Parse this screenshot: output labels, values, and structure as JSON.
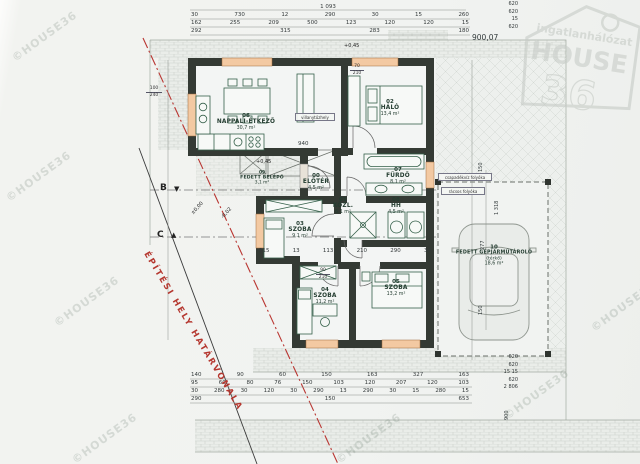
{
  "sheet": {
    "elevation": "900,07"
  },
  "watermark": {
    "text": "©HOUSE36"
  },
  "logo": {
    "top": "ingatlanhálózat",
    "main": "HOUSE",
    "number": "36"
  },
  "boundary": {
    "label": "ÉPÍTÉSI HELY HATÁRVONALA"
  },
  "markers": {
    "b": "B",
    "c": "C",
    "b_tri": "▼",
    "c_tri": "▲"
  },
  "levels": {
    "zero": "±0,00",
    "minus": "-0,02",
    "plus": "+0,45"
  },
  "rooms": [
    {
      "num": "00",
      "name": "ELŐTÉR",
      "area": "4,5 m²"
    },
    {
      "num": "01",
      "name": "KÖZL.",
      "area": "6,1 m²"
    },
    {
      "num": "02",
      "name": "HÁLÓ",
      "area": "13,4 m²"
    },
    {
      "num": "03",
      "name": "SZOBA",
      "area": "9,1 m²"
    },
    {
      "num": "04",
      "name": "SZOBA",
      "area": "11,2 m²"
    },
    {
      "num": "05",
      "name": "SZOBA",
      "area": "13,2 m²"
    },
    {
      "num": "06",
      "name": "NAPPALI-ÉTKEZŐ",
      "area": "30,7 m²"
    },
    {
      "num": "07",
      "name": "FÜRDŐ",
      "area": "8,1 m²"
    },
    {
      "num": "08",
      "name": "HH",
      "area": "4,5 m²"
    },
    {
      "num": "09",
      "name": "FEDETT BELÉPŐ",
      "area": "3,1 m²"
    },
    {
      "num": "10",
      "name": "FEDETT GÉPJÁRMŰTÁROLÓ",
      "sub": "(térkő)",
      "area": "18,6 m²"
    }
  ],
  "dims": {
    "top": [
      [
        "1 093"
      ],
      [
        "30",
        "730",
        "12",
        "290",
        "30",
        "15",
        "260"
      ],
      [
        "162",
        "255",
        "209",
        "500",
        "123",
        "120",
        "120",
        "15"
      ],
      [
        "292",
        "315",
        "283",
        "180"
      ]
    ],
    "top_right_col": [
      "620",
      "620",
      "15",
      "620"
    ],
    "bottom": [
      [
        "140",
        "90",
        "60",
        "150",
        "163",
        "327",
        "163"
      ],
      [
        "95",
        "60",
        "80",
        "76",
        "150",
        "103",
        "120",
        "207",
        "120",
        "103"
      ],
      [
        "30",
        "280",
        "30",
        "120",
        "30",
        "290",
        "13",
        "290",
        "30",
        "15",
        "280",
        "15"
      ],
      [
        "290",
        "150",
        "653"
      ]
    ],
    "bottom_right_col": [
      "620",
      "620",
      "15  15",
      "620",
      "2 806"
    ],
    "right_vertical": [
      "150",
      "1 318",
      "277",
      "150"
    ],
    "bottom_vertical": "900",
    "inner_row": [
      "315",
      "13",
      "113",
      "210",
      "290",
      "30"
    ],
    "inner_misc": [
      "940"
    ]
  },
  "specs": {
    "w1": [
      "100",
      "240"
    ],
    "d1": [
      "70",
      "210"
    ],
    "d2": [
      "90",
      "210"
    ]
  },
  "annotations": {
    "box1": "csapadékvíz folyóka",
    "box2": "rácsos folyóka",
    "box3": "villanytűzhely"
  }
}
